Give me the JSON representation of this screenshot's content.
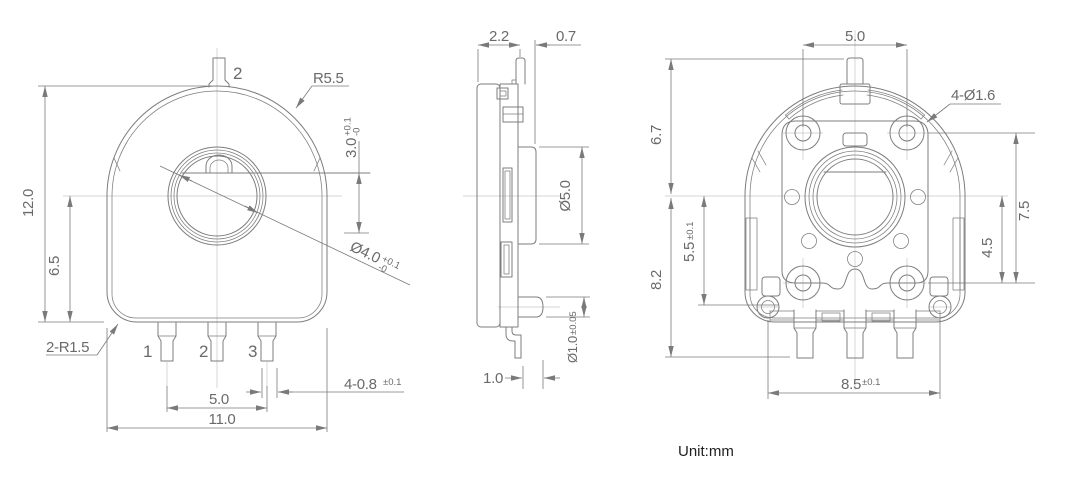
{
  "colors": {
    "bg": "#ffffff",
    "line": "#7d7d7d",
    "centerline": "#c6c6c6",
    "dim": "#7a7a7a",
    "text": "#6a6a6a",
    "ink": "#1f1f1f"
  },
  "unit_note": "Unit:mm",
  "front_view": {
    "terminal_2_label": "2",
    "body_radius": "R5.5",
    "overall_height": "12.0",
    "center_height": "6.5",
    "dflat": {
      "value": "3.0",
      "tol_plus": "+0.1",
      "tol_minus": "-0"
    },
    "bore": {
      "value": "Ø4.0",
      "tol_plus": "+0.1",
      "tol_minus": "-0"
    },
    "corner_radius": "2-R1.5",
    "pin_labels": [
      "1",
      "2",
      "3"
    ],
    "pin_width": {
      "value": "4-0.8",
      "tol": "±0.1"
    },
    "pin_span": "5.0",
    "overall_width": "11.0"
  },
  "side_view": {
    "body_depth": "2.2",
    "boss_depth": "0.7",
    "rotor_dia": "Ø5.0",
    "pin_dia": {
      "value": "Ø1.0",
      "tol": "±0.05"
    },
    "pin_offset": "1.0"
  },
  "back_view": {
    "hole_span": "5.0",
    "mount_holes": "4-Ø1.6",
    "upper_height": "6.7",
    "lower_height": "8.2",
    "eyelet_offset": {
      "value": "5.5",
      "tol": "±0.1"
    },
    "hole_row_span": "7.5",
    "center_to_hole": "4.5",
    "eyelet_span": {
      "value": "8.5",
      "tol": "±0.1"
    }
  }
}
